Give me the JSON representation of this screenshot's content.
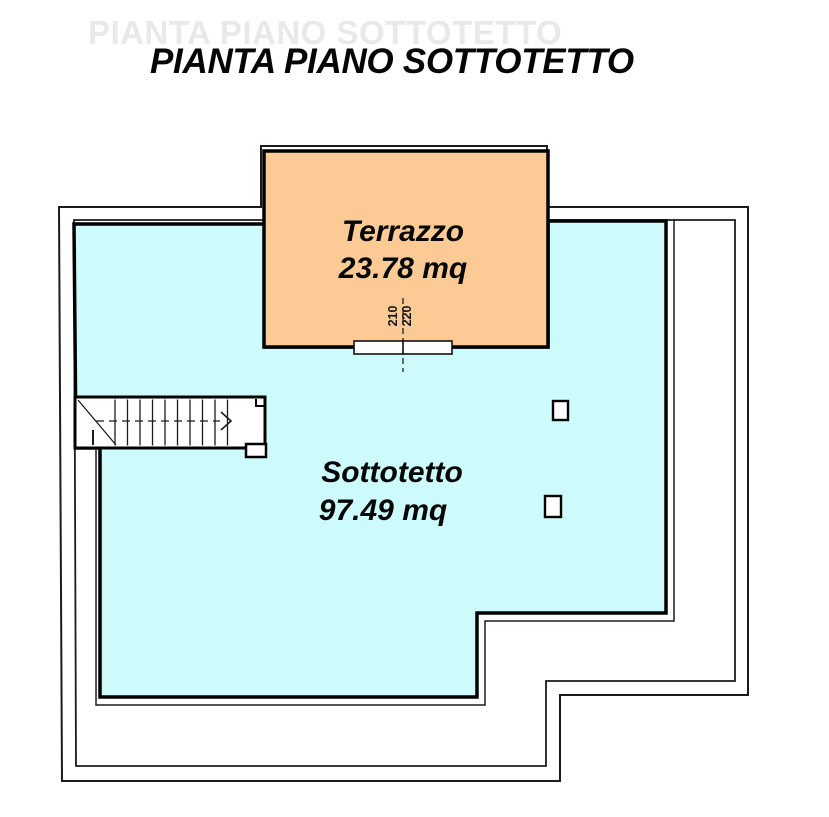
{
  "plan": {
    "ghost_title": "PIANTA PIANO SOTTOTETTO",
    "title": "PIANTA PIANO SOTTOTETTO"
  },
  "rooms": {
    "terrazzo": {
      "name": "Terrazzo",
      "area": "23.78 mq",
      "fill": "#FBCA95"
    },
    "sottotetto": {
      "name": "Sottotetto",
      "area": "97.49 mq",
      "fill": "#CDFAFA"
    }
  },
  "door_dimension": {
    "numerator": "210",
    "denominator": "220"
  },
  "colors": {
    "line": "#1b1b1b",
    "wall": "#000000",
    "paper": "#ffffff"
  }
}
